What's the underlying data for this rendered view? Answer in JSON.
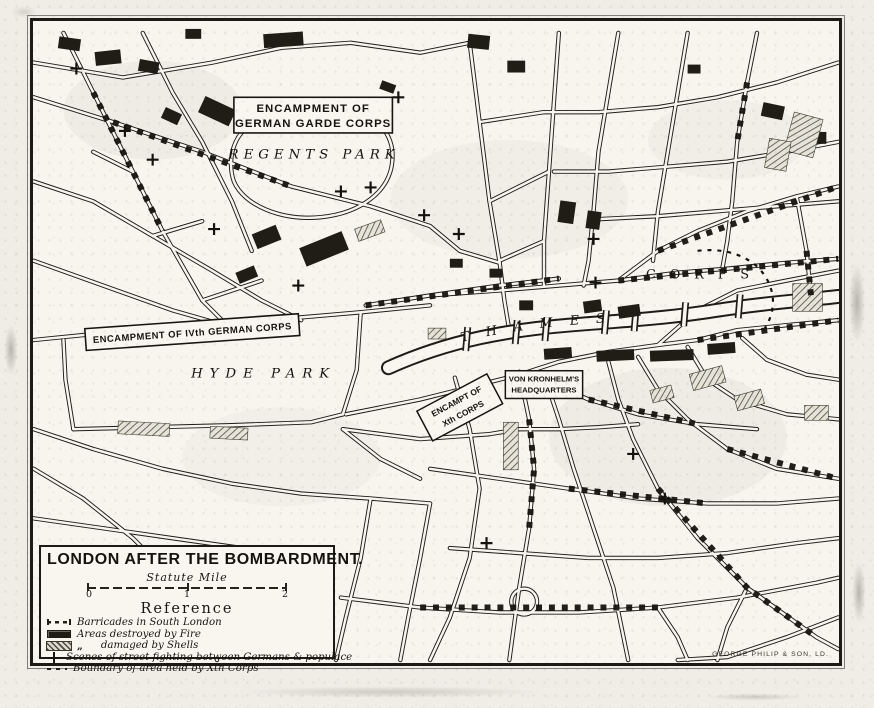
{
  "map": {
    "title": "LONDON AFTER THE BOMBARDMENT.",
    "scale": {
      "label": "Statute Mile",
      "ticks": [
        "0",
        "1",
        "2"
      ]
    },
    "reference": {
      "heading": "Reference",
      "items": [
        {
          "icon": "barricade-dashes-icon",
          "label": "Barricades in South London"
        },
        {
          "icon": "solid-black-swatch-icon",
          "label": "Areas destroyed by Fire"
        },
        {
          "icon": "hatched-swatch-icon",
          "ditto": "„",
          "label": "damaged by Shells"
        },
        {
          "icon": "cross-icon",
          "label": "Scenes of street fighting between Germans & populace"
        },
        {
          "icon": "dashed-line-icon",
          "label": "Boundary of area held by Xth Corps"
        }
      ]
    },
    "labels": {
      "garde_line1": "ENCAMPMENT OF",
      "garde_line2": "GERMAN GARDE CORPS",
      "regents_park": "REGENTS PARK",
      "iv_corps": "ENCAMPMENT OF IVth GERMAN CORPS",
      "hyde_park": "HYDE PARK",
      "von_line1": "VON KRONHELM'S",
      "von_line2": "HEADQUARTERS",
      "x_corps_line1": "ENCAMPT OF",
      "x_corps_line2": "Xth CORPS",
      "thames": "THAMES",
      "corps_area": "CORPS"
    },
    "credit": "GEORGE PHILIP & SON, LD.",
    "colors": {
      "ink": "#1b1914",
      "paper": "#f7f5ee"
    }
  }
}
